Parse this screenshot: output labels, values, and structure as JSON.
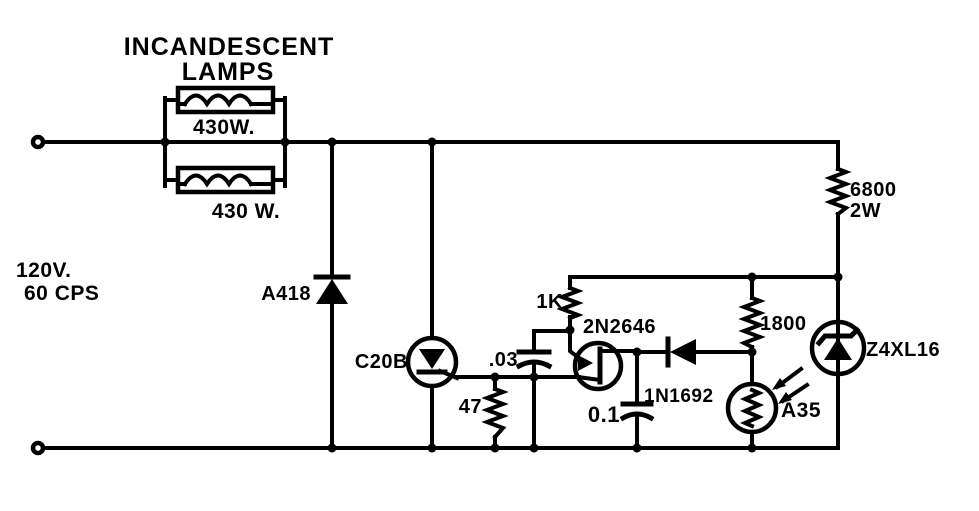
{
  "diagram": {
    "type": "schematic-circuit",
    "title": {
      "line1": "INCANDESCENT",
      "line2": "LAMPS"
    },
    "source": {
      "voltage": "120V.",
      "frequency": "60 CPS"
    },
    "components": {
      "lamp_top": {
        "label": "430W.",
        "kind": "incandescent-lamp"
      },
      "lamp_bottom": {
        "label": "430 W.",
        "kind": "incandescent-lamp"
      },
      "rectifier": {
        "label": "A418",
        "kind": "diode"
      },
      "scr": {
        "label": "C20B",
        "kind": "scr-thyristor"
      },
      "ballast_resistor": {
        "label": "6800",
        "power": "2W",
        "kind": "resistor"
      },
      "gate_resistor": {
        "label": "47",
        "kind": "resistor"
      },
      "coupling_capacitor": {
        "label": ".03",
        "kind": "capacitor"
      },
      "base2_resistor": {
        "label": "1K",
        "kind": "resistor"
      },
      "ujt": {
        "label": "2N2646",
        "kind": "unijunction-transistor"
      },
      "timing_capacitor": {
        "label": "0.1",
        "kind": "capacitor"
      },
      "diode": {
        "label": "1N1692",
        "kind": "diode"
      },
      "divider_resistor": {
        "label": "1800",
        "kind": "resistor"
      },
      "photocell": {
        "label": "A35",
        "kind": "photoconductive-cell"
      },
      "zener": {
        "label": "Z4XL16",
        "kind": "zener-diode"
      }
    }
  },
  "colors": {
    "ink": "#000000",
    "background": "#ffffff"
  }
}
